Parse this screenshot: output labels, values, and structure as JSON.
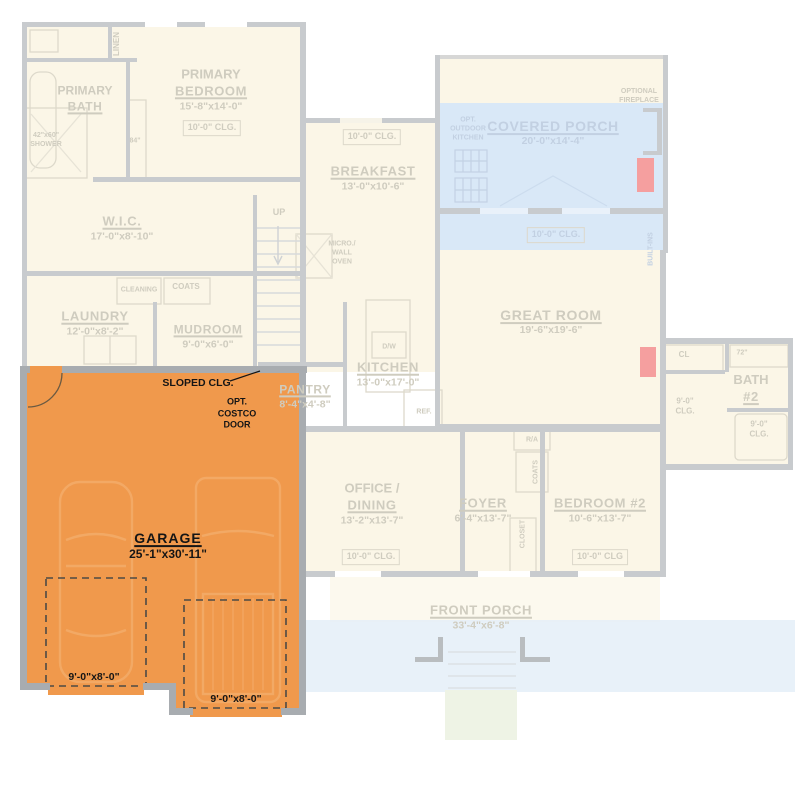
{
  "plan_title": "First floor plan with garage highlighted",
  "colors": {
    "highlight_orange": "#F0994C",
    "porch_tint_blue": "#D9E8F7",
    "accent_red": "#F59F9F",
    "faded_wall_gray": "#C8CBCE",
    "garage_wall_gray": "#A8ACB0",
    "faded_text": "#CFCCBF",
    "black_text": "#151515"
  },
  "rooms": {
    "primary_bath": {
      "l1": "PRIMARY",
      "l2": "BATH"
    },
    "primary_bedroom": {
      "l1": "PRIMARY",
      "l2": "BEDROOM",
      "dims": "15'-8\"x14'-0\"",
      "clg": "10'-0\" CLG."
    },
    "wic": {
      "l1": "W.I.C.",
      "dims": "17'-0\"x8'-10\""
    },
    "laundry": {
      "l1": "LAUNDRY",
      "dims": "12'-0\"x8'-2\""
    },
    "mudroom": {
      "l1": "MUDROOM",
      "dims": "9'-0\"x6'-0\""
    },
    "breakfast": {
      "l1": "BREAKFAST",
      "dims": "13'-0\"x10'-6\"",
      "clg": "10'-0\" CLG."
    },
    "covered_porch": {
      "l1": "COVERED PORCH",
      "dims": "20'-0\"x14'-4\"",
      "clg": "10'-0\" CLG."
    },
    "great_room": {
      "l1": "GREAT ROOM",
      "dims": "19'-6\"x19'-6\""
    },
    "kitchen": {
      "l1": "KITCHEN",
      "dims": "13'-0\"x17'-0\""
    },
    "pantry": {
      "l1": "PANTRY",
      "dims": "8'-4\"x4'-8\""
    },
    "office_dining": {
      "l1": "OFFICE /",
      "l2": "DINING",
      "dims": "13'-2\"x13'-7\"",
      "clg": "10'-0\" CLG."
    },
    "foyer": {
      "l1": "FOYER",
      "dims": "6'-4\"x13'-7\""
    },
    "bedroom2": {
      "l1": "BEDROOM #2",
      "dims": "10'-6\"x13'-7\"",
      "clg": "10'-0\" CLG"
    },
    "bath2": {
      "l1": "BATH",
      "l2": "#2"
    },
    "front_porch": {
      "l1": "FRONT PORCH",
      "dims": "33'-4\"x6'-8\""
    },
    "garage": {
      "l1": "GARAGE",
      "dims": "25'-1\"x30'-11\"",
      "door_left": "9'-0\"x8'-0\"",
      "door_right": "9'-0\"x8'-0\""
    }
  },
  "annotations": {
    "linen": "LINEN",
    "shower": {
      "l1": "42\"x60\"",
      "l2": "SHOWER"
    },
    "vanity_84": "84\"",
    "up": "UP",
    "cleaning": "CLEANING",
    "coats_mudroom": "COATS",
    "micro": {
      "l1": "MICRO./",
      "l2": "WALL",
      "l3": "OVEN"
    },
    "opt_outdoor_kitchen": {
      "l1": "OPT.",
      "l2": "OUTDOOR",
      "l3": "KITCHEN"
    },
    "optional_fireplace": {
      "l1": "OPTIONAL",
      "l2": "FIREPLACE"
    },
    "built_ins": "BUILT-INS",
    "dw": "D/W",
    "ref": "REF.",
    "cl": "CL",
    "vanity_72": "72\"",
    "hall_clg": {
      "l1": "9'-0\"",
      "l2": "CLG."
    },
    "bath2_clg": {
      "l1": "9'-0\"",
      "l2": "CLG."
    },
    "ra": "R/A",
    "coats_foyer": "COATS",
    "closet_foyer": "CLOSET",
    "sloped_clg": "SLOPED CLG.",
    "costco": {
      "l1": "OPT.",
      "l2": "COSTCO",
      "l3": "DOOR"
    }
  }
}
